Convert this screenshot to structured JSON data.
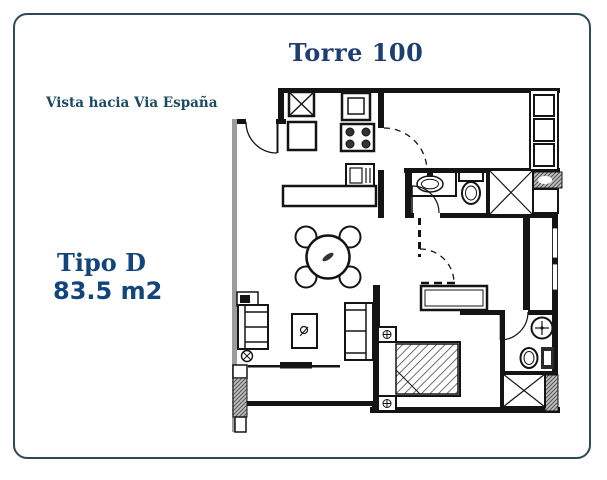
{
  "header": {
    "title": "Torre 100"
  },
  "labels": {
    "view": "Vista hacia Via España",
    "type": "Tipo D",
    "area": "83.5 m2"
  },
  "colors": {
    "frame_border": "#2d4b57",
    "title_navy": "#1c3e70",
    "view_label_navy": "#1b4a63",
    "type_navy": "#12457c",
    "plan_line": "#141414",
    "wall_gray": "#9c9c9c"
  }
}
